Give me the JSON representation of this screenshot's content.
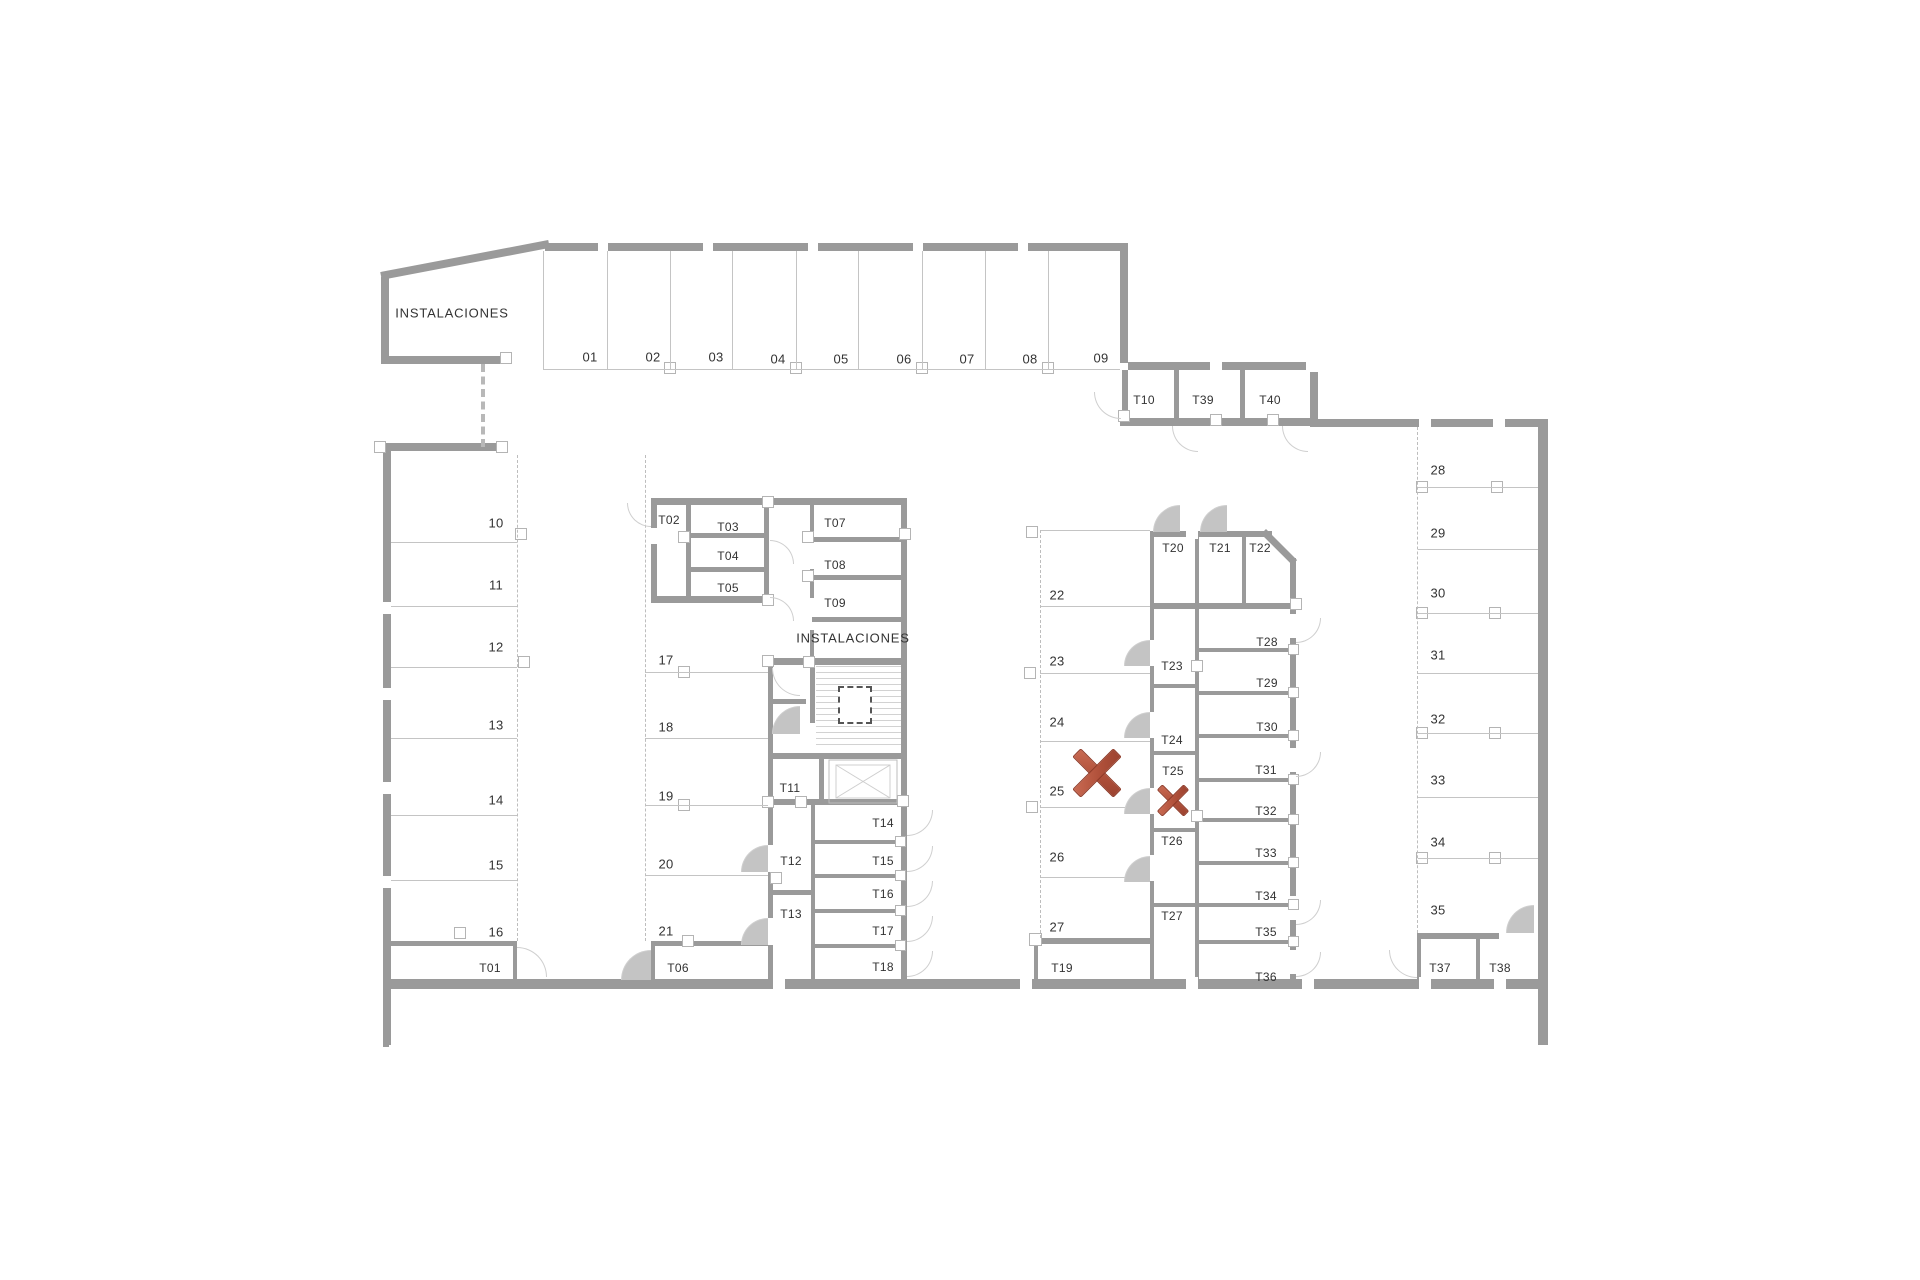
{
  "meta": {
    "background": "#ffffff",
    "wall_color": "#9a9a9a",
    "thin_line_color": "#c4c4c4",
    "text_color": "#333333",
    "annotation_color": "#b0503a"
  },
  "floor_plan": {
    "room_labels": [
      {
        "text": "INSTALACIONES",
        "x": 452,
        "y": 313
      },
      {
        "text": "INSTALACIONES",
        "x": 853,
        "y": 638
      }
    ],
    "parking_spaces": [
      {
        "id": "01",
        "x": 590,
        "y": 357
      },
      {
        "id": "02",
        "x": 653,
        "y": 357
      },
      {
        "id": "03",
        "x": 716,
        "y": 357
      },
      {
        "id": "04",
        "x": 778,
        "y": 359
      },
      {
        "id": "05",
        "x": 841,
        "y": 359
      },
      {
        "id": "06",
        "x": 904,
        "y": 359
      },
      {
        "id": "07",
        "x": 967,
        "y": 359
      },
      {
        "id": "08",
        "x": 1030,
        "y": 359
      },
      {
        "id": "09",
        "x": 1101,
        "y": 358
      },
      {
        "id": "10",
        "x": 496,
        "y": 523
      },
      {
        "id": "11",
        "x": 496,
        "y": 585
      },
      {
        "id": "12",
        "x": 496,
        "y": 647
      },
      {
        "id": "13",
        "x": 496,
        "y": 725
      },
      {
        "id": "14",
        "x": 496,
        "y": 800
      },
      {
        "id": "15",
        "x": 496,
        "y": 865
      },
      {
        "id": "16",
        "x": 496,
        "y": 932
      },
      {
        "id": "17",
        "x": 666,
        "y": 660
      },
      {
        "id": "18",
        "x": 666,
        "y": 727
      },
      {
        "id": "19",
        "x": 666,
        "y": 796
      },
      {
        "id": "20",
        "x": 666,
        "y": 864
      },
      {
        "id": "21",
        "x": 666,
        "y": 931
      },
      {
        "id": "22",
        "x": 1057,
        "y": 595
      },
      {
        "id": "23",
        "x": 1057,
        "y": 661
      },
      {
        "id": "24",
        "x": 1057,
        "y": 722
      },
      {
        "id": "25",
        "x": 1057,
        "y": 791
      },
      {
        "id": "26",
        "x": 1057,
        "y": 857
      },
      {
        "id": "27",
        "x": 1057,
        "y": 927
      },
      {
        "id": "28",
        "x": 1438,
        "y": 470
      },
      {
        "id": "29",
        "x": 1438,
        "y": 533
      },
      {
        "id": "30",
        "x": 1438,
        "y": 593
      },
      {
        "id": "31",
        "x": 1438,
        "y": 655
      },
      {
        "id": "32",
        "x": 1438,
        "y": 719
      },
      {
        "id": "33",
        "x": 1438,
        "y": 780
      },
      {
        "id": "34",
        "x": 1438,
        "y": 842
      },
      {
        "id": "35",
        "x": 1438,
        "y": 910
      }
    ],
    "storage_units": [
      {
        "id": "T01",
        "x": 490,
        "y": 968
      },
      {
        "id": "T02",
        "x": 669,
        "y": 520
      },
      {
        "id": "T03",
        "x": 728,
        "y": 527
      },
      {
        "id": "T04",
        "x": 728,
        "y": 556
      },
      {
        "id": "T05",
        "x": 728,
        "y": 588
      },
      {
        "id": "T06",
        "x": 678,
        "y": 968
      },
      {
        "id": "T07",
        "x": 835,
        "y": 523
      },
      {
        "id": "T08",
        "x": 835,
        "y": 565
      },
      {
        "id": "T09",
        "x": 835,
        "y": 603
      },
      {
        "id": "T10",
        "x": 1144,
        "y": 400
      },
      {
        "id": "T11",
        "x": 790,
        "y": 788
      },
      {
        "id": "T12",
        "x": 791,
        "y": 861
      },
      {
        "id": "T13",
        "x": 791,
        "y": 914
      },
      {
        "id": "T14",
        "x": 883,
        "y": 823
      },
      {
        "id": "T15",
        "x": 883,
        "y": 861
      },
      {
        "id": "T16",
        "x": 883,
        "y": 894
      },
      {
        "id": "T17",
        "x": 883,
        "y": 931
      },
      {
        "id": "T18",
        "x": 883,
        "y": 967
      },
      {
        "id": "T19",
        "x": 1062,
        "y": 968
      },
      {
        "id": "T20",
        "x": 1173,
        "y": 548
      },
      {
        "id": "T21",
        "x": 1220,
        "y": 548
      },
      {
        "id": "T22",
        "x": 1260,
        "y": 548
      },
      {
        "id": "T23",
        "x": 1172,
        "y": 666
      },
      {
        "id": "T24",
        "x": 1172,
        "y": 740
      },
      {
        "id": "T25",
        "x": 1173,
        "y": 771
      },
      {
        "id": "T26",
        "x": 1172,
        "y": 841
      },
      {
        "id": "T27",
        "x": 1172,
        "y": 916
      },
      {
        "id": "T28",
        "x": 1267,
        "y": 642
      },
      {
        "id": "T29",
        "x": 1267,
        "y": 683
      },
      {
        "id": "T30",
        "x": 1267,
        "y": 727
      },
      {
        "id": "T31",
        "x": 1266,
        "y": 770
      },
      {
        "id": "T32",
        "x": 1266,
        "y": 811
      },
      {
        "id": "T33",
        "x": 1266,
        "y": 853
      },
      {
        "id": "T34",
        "x": 1266,
        "y": 896
      },
      {
        "id": "T35",
        "x": 1266,
        "y": 932
      },
      {
        "id": "T36",
        "x": 1266,
        "y": 977
      },
      {
        "id": "T37",
        "x": 1440,
        "y": 968
      },
      {
        "id": "T38",
        "x": 1500,
        "y": 968
      },
      {
        "id": "T39",
        "x": 1203,
        "y": 400
      },
      {
        "id": "T40",
        "x": 1270,
        "y": 400
      }
    ],
    "annotations": [
      {
        "type": "cross",
        "x": 1097,
        "y": 773,
        "w": 44,
        "h": 38,
        "bar": 12
      },
      {
        "type": "cross",
        "x": 1173,
        "y": 800,
        "w": 28,
        "h": 25,
        "bar": 8
      }
    ]
  }
}
